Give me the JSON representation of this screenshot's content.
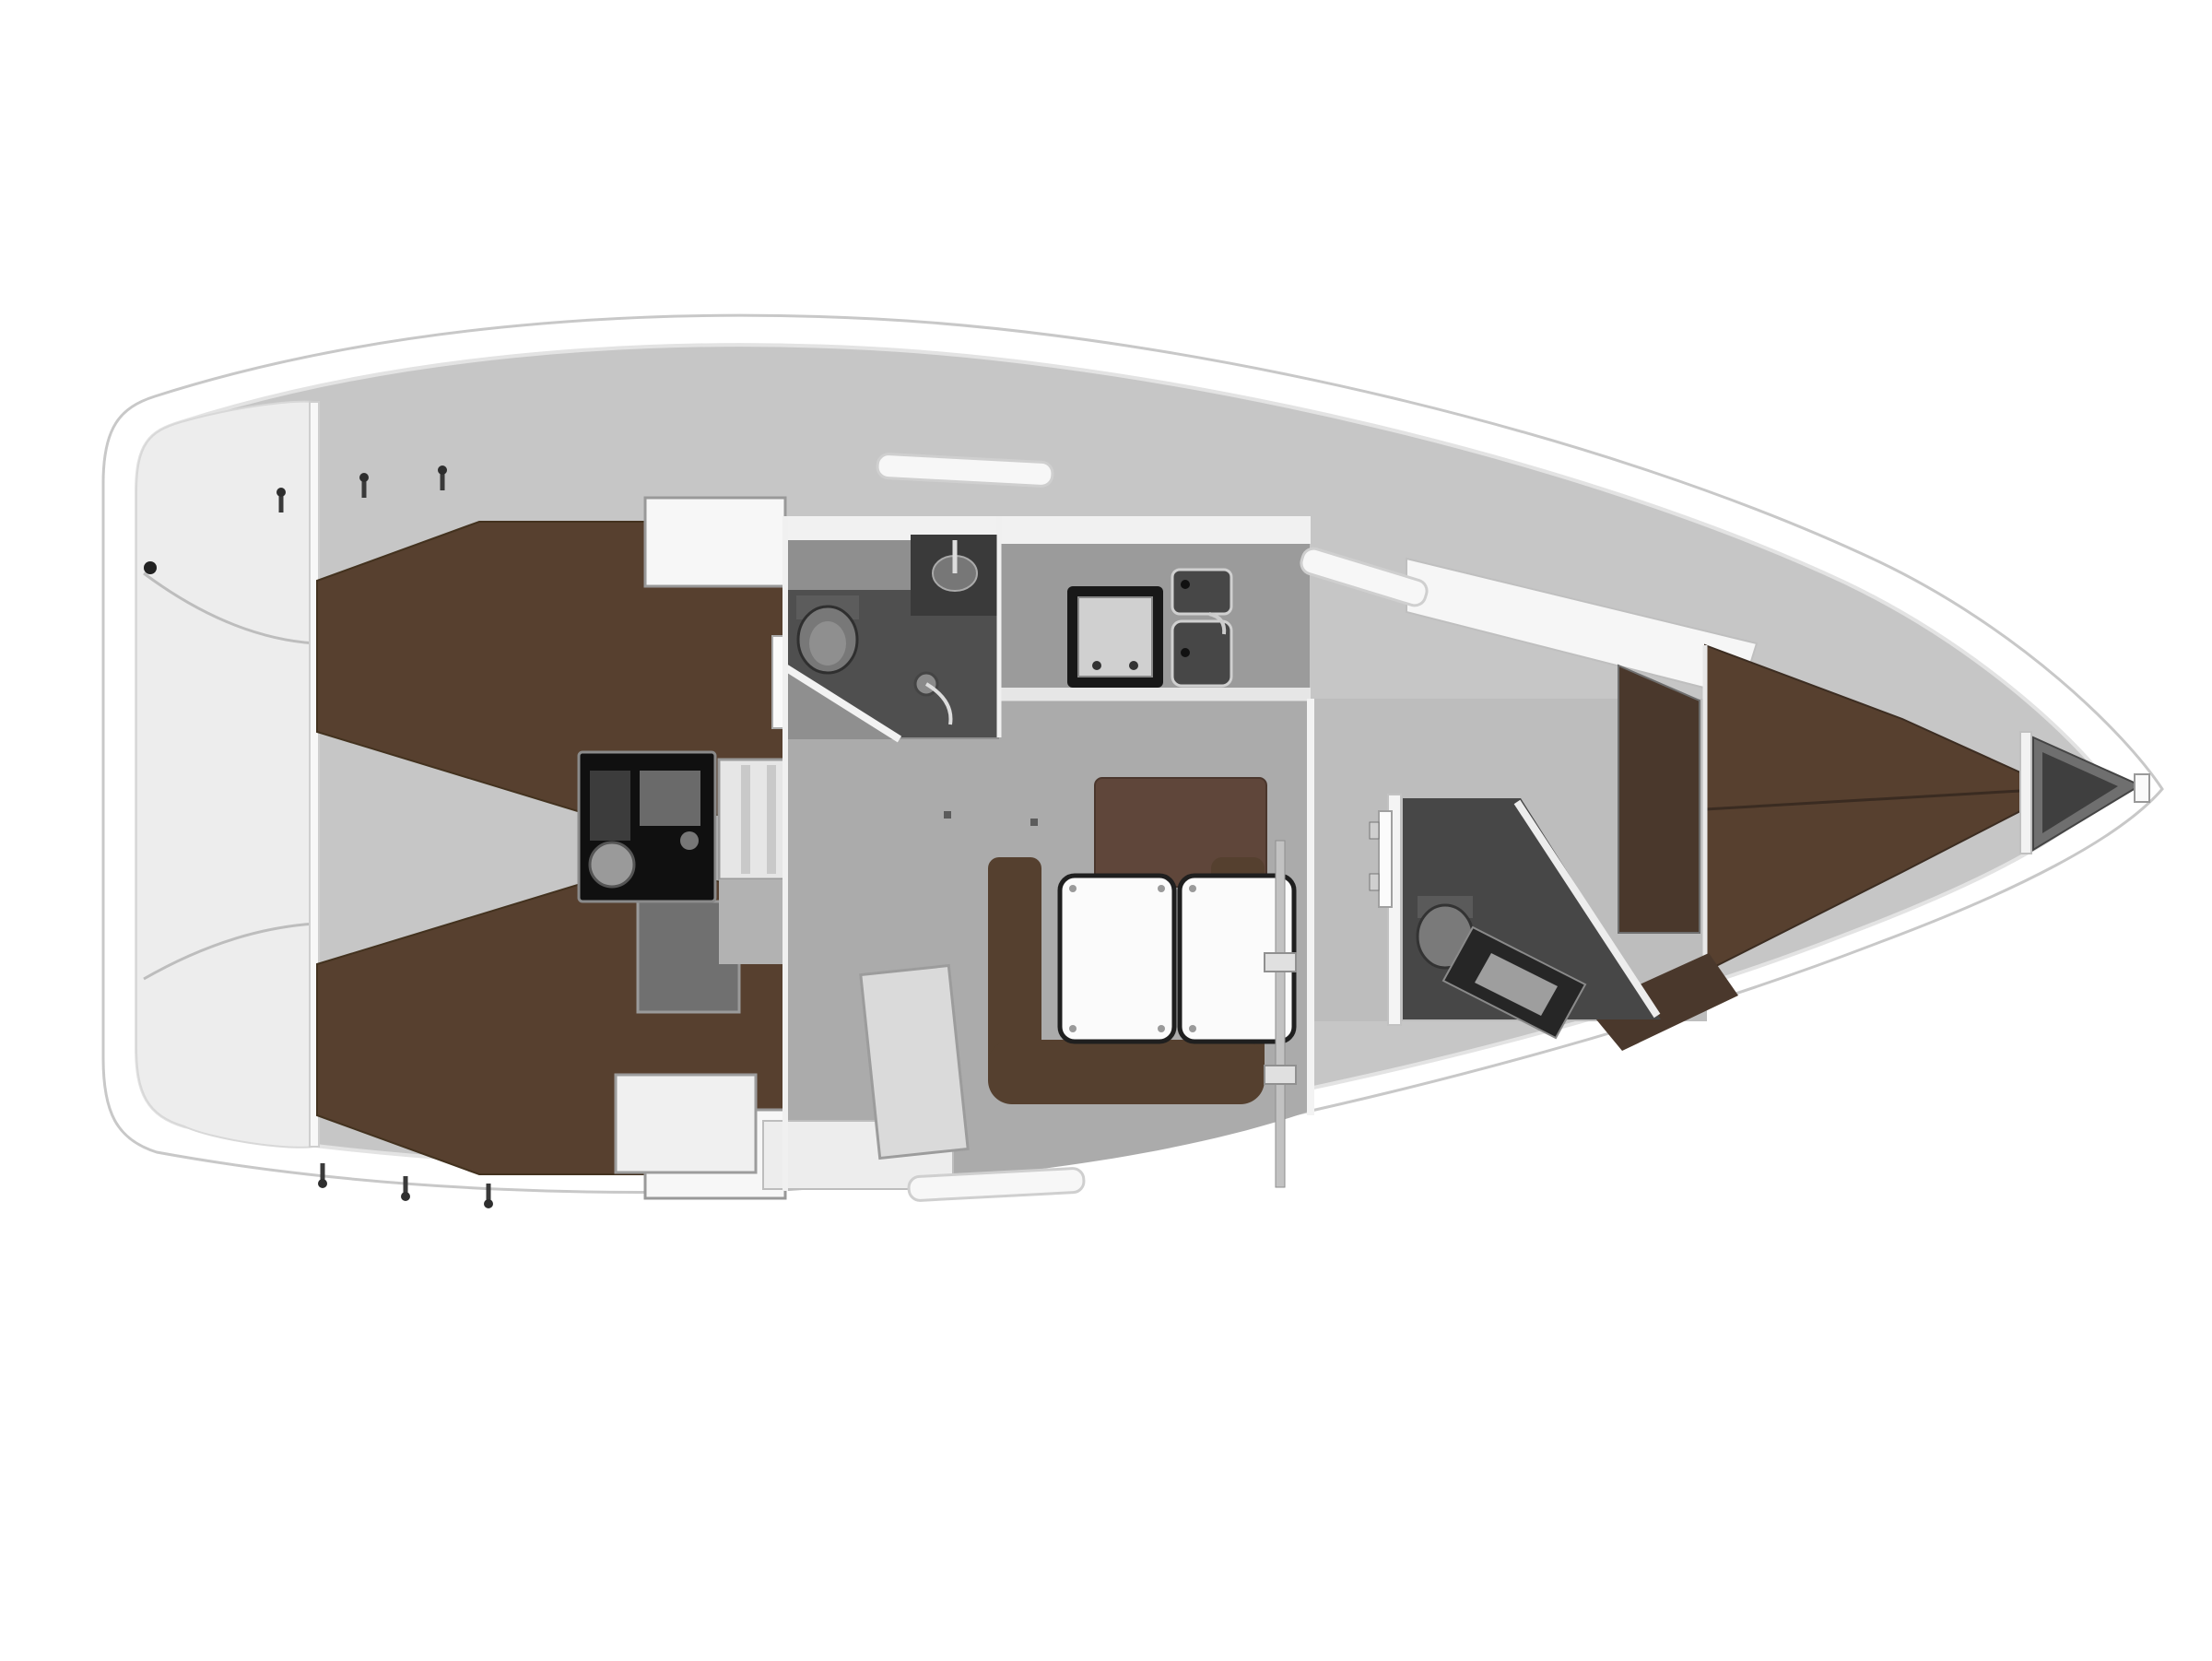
{
  "page": {
    "title": "Sailing yacht interior layout - top view floor plan",
    "background": "#ffffff"
  },
  "plan": {
    "type": "yacht-floor-plan",
    "view": "top-down cutaway render",
    "orientation": {
      "bow": "right",
      "stern": "left"
    },
    "rooms": {
      "hull": {
        "label": "Yacht hull, deck outline"
      },
      "stern_platform": {
        "label": "Stern transom and swim platform"
      },
      "aft_cabin_port": {
        "label": "Port aft double cabin with berth and locker"
      },
      "aft_cabin_starboard": {
        "label": "Starboard aft double cabin with berth and locker"
      },
      "engine_compartment": {
        "label": "Engine compartment under cockpit"
      },
      "companionway": {
        "label": "Companionway entry steps"
      },
      "head_aft": {
        "label": "Aft head with shower, toilet and wash basin"
      },
      "galley": {
        "label": "Galley with gimballed stove and twin sinks"
      },
      "salon": {
        "label": "Salon with U-shaped settee, backrest bench and folding table"
      },
      "nav_area": {
        "label": "Navigation seat and lockers"
      },
      "head_forward": {
        "label": "Forward head with toilet and angled vanity"
      },
      "forward_cabin": {
        "label": "Forward cabin with V-berth, shelf and hanging locker"
      },
      "anchor_locker": {
        "label": "Anchor locker at the bow"
      }
    },
    "furniture": {
      "berths": [
        "port aft double berth",
        "starboard aft double berth",
        "forward V-berth"
      ],
      "salon": [
        "U-shaped settee",
        "backrest bench",
        "double folding table",
        "support post"
      ],
      "galley": [
        "stove with oven",
        "upper sink",
        "lower sink",
        "worktop"
      ],
      "heads": [
        "aft toilet",
        "aft wash basin",
        "shower head",
        "forward toilet",
        "forward vanity"
      ],
      "other": [
        "engine block",
        "companionway steps",
        "wardrobe lockers",
        "anchor locker"
      ]
    },
    "colors": {
      "hull_outline": "#c8c8c8",
      "deck_gray": "#c6c6c6",
      "platform": "#eeeeee",
      "cabin_floor": "#ababab",
      "berth_brown": "#57402f",
      "wood_dark": "#4a382c",
      "backrest_brown": "#5f463a",
      "head_floor": "#4a4a4a",
      "table_white": "#fbfbfb",
      "engine_dark": "#101010",
      "chrome": "#c2c2c2"
    }
  }
}
